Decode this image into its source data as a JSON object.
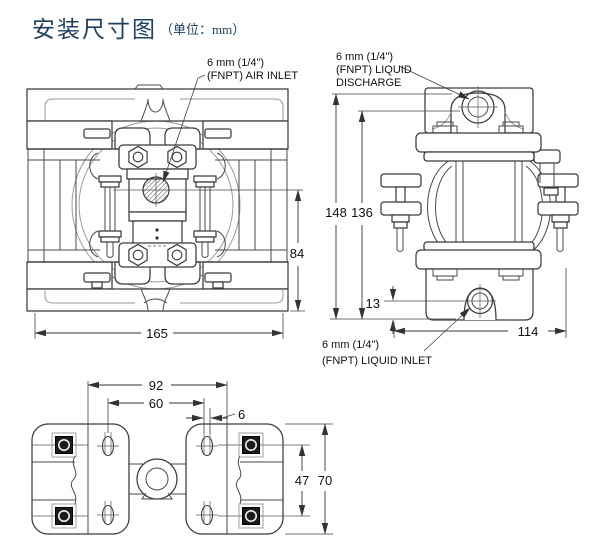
{
  "title": {
    "text": "安装尺寸图",
    "unit_note": "（单位：mm）"
  },
  "colors": {
    "title_text": "#1f4060",
    "drawing_line": "#3a3a3a",
    "dim_text": "#111111",
    "background": "#ffffff"
  },
  "port_labels": {
    "air_inlet": {
      "line1": "6 mm (1/4\")",
      "line2": "(FNPT) AIR INLET"
    },
    "liquid_discharge": {
      "line1": "6 mm (1/4\")",
      "line2": "(FNPT) LIQUID",
      "line3": "DISCHARGE"
    },
    "liquid_inlet": {
      "line1": "6 mm (1/4\")",
      "line2": "(FNPT) LIQUID INLET"
    }
  },
  "dimensions": {
    "front_inlet_height": "84",
    "front_overall_width": "165",
    "side_overall_height": "148",
    "side_discharge_height": "136",
    "side_inlet_offset": "13",
    "side_overall_depth": "114",
    "base_outer_bolt_span": "92",
    "base_slot_span": "60",
    "base_slot_width": "6",
    "base_bolt_row_depth": "47",
    "base_overall_depth": "70"
  }
}
